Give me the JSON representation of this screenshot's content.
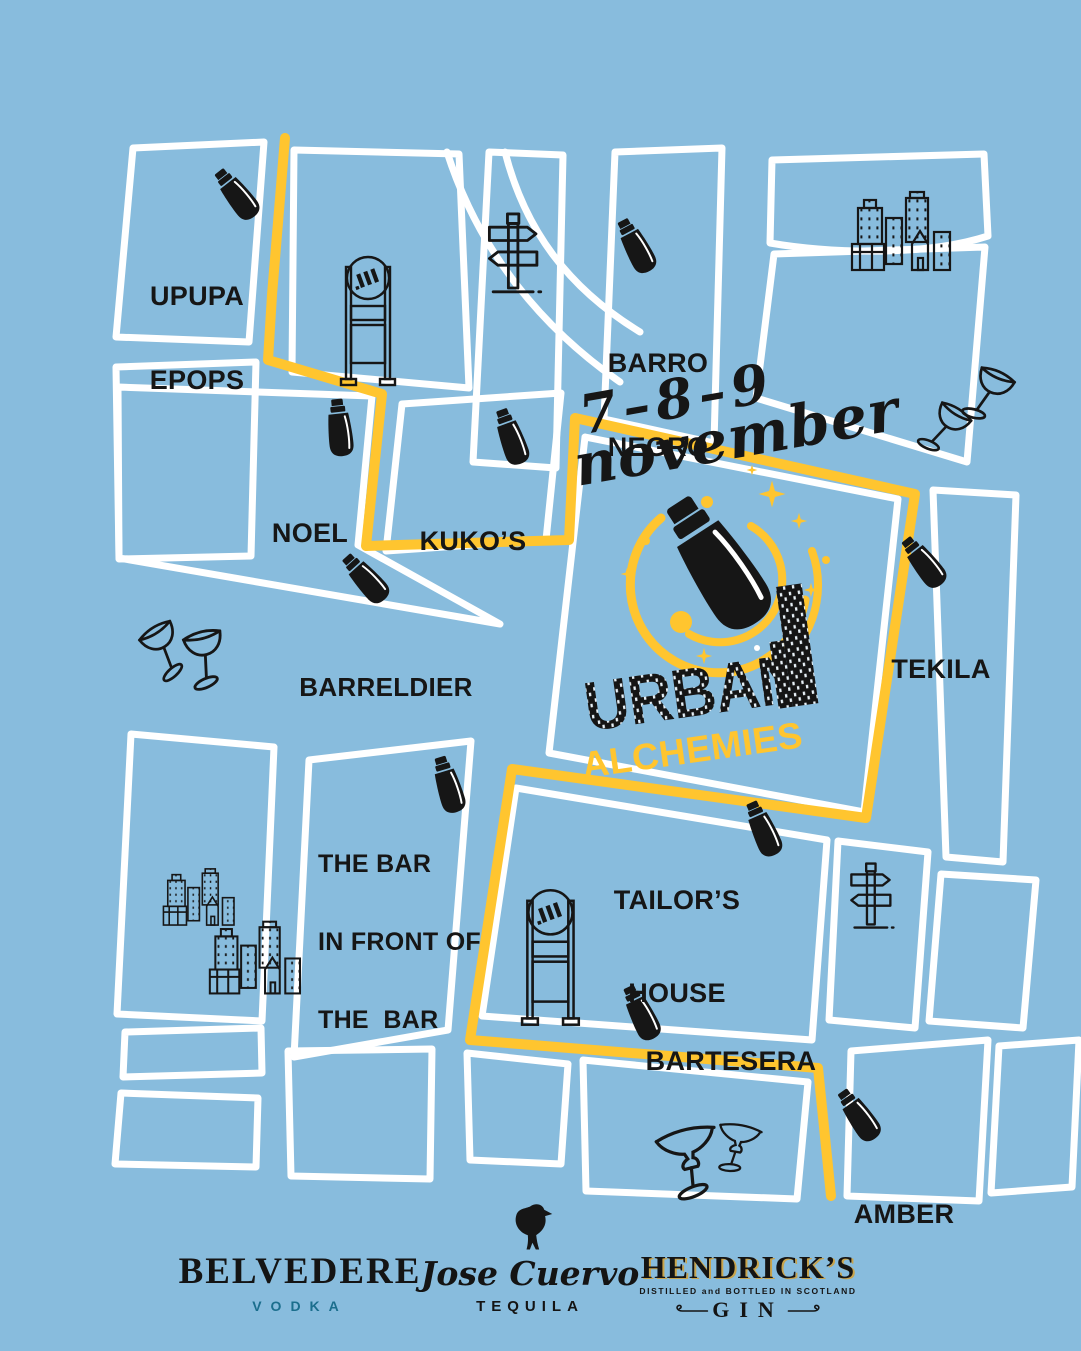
{
  "event": {
    "dates": "7–8–9",
    "month": "november",
    "title_top": "URBAN",
    "title_bottom": "ALCHEMIES"
  },
  "venues": [
    {
      "id": "upupa-epops",
      "lines": [
        "UPUPA",
        "EPOPS"
      ]
    },
    {
      "id": "noel",
      "lines": [
        "NOEL"
      ]
    },
    {
      "id": "kukos",
      "lines": [
        "KUKO’S"
      ]
    },
    {
      "id": "barro-negro",
      "lines": [
        "BARRO",
        "NEGRO"
      ]
    },
    {
      "id": "barreldier",
      "lines": [
        "BARRELDIER"
      ]
    },
    {
      "id": "tekila",
      "lines": [
        "TEKILA"
      ]
    },
    {
      "id": "the-bar-in-front-of-the-bar",
      "lines": [
        "THE BAR",
        "IN FRONT OF",
        "THE  BAR"
      ]
    },
    {
      "id": "tailors-house",
      "lines": [
        "TAILOR’S",
        "HOUSE"
      ]
    },
    {
      "id": "bartesera",
      "lines": [
        "BARTESERA"
      ]
    },
    {
      "id": "amber",
      "lines": [
        "AMBER"
      ]
    }
  ],
  "sponsors": {
    "belvedere": {
      "name": "BELVEDERE",
      "type": "VODKA"
    },
    "jose_cuervo": {
      "name": "Jose Cuervo",
      "type": "TEQUILA"
    },
    "hendricks": {
      "name": "HENDRICK’S",
      "tagline": "DISTILLED and BOTTLED IN SCOTLAND",
      "type": "GIN"
    }
  },
  "colors": {
    "background": "#88BCDD",
    "route_yellow": "#FFC52F",
    "street_white": "#FFFFFF",
    "ink_black": "#161616",
    "vodka_teal": "#1B6E8D",
    "hendricks_gold": "#C9A44C"
  },
  "icons": {
    "cocktail-shaker-icon": "black shaker marking each venue",
    "big-shaker-icon": "central logo shaker with yellow swirls and sparkles",
    "coupe-glasses-icon": "outlined coupe glasses decor",
    "margarita-glasses-icon": "outlined margarita glasses decor",
    "city-buildings-icon": "outlined skyline decor",
    "signpost-icon": "direction arrows signpost decor",
    "ad-panel-icon": "street advertising panel with M logo",
    "crow-icon": "Jose Cuervo crow emblem"
  }
}
